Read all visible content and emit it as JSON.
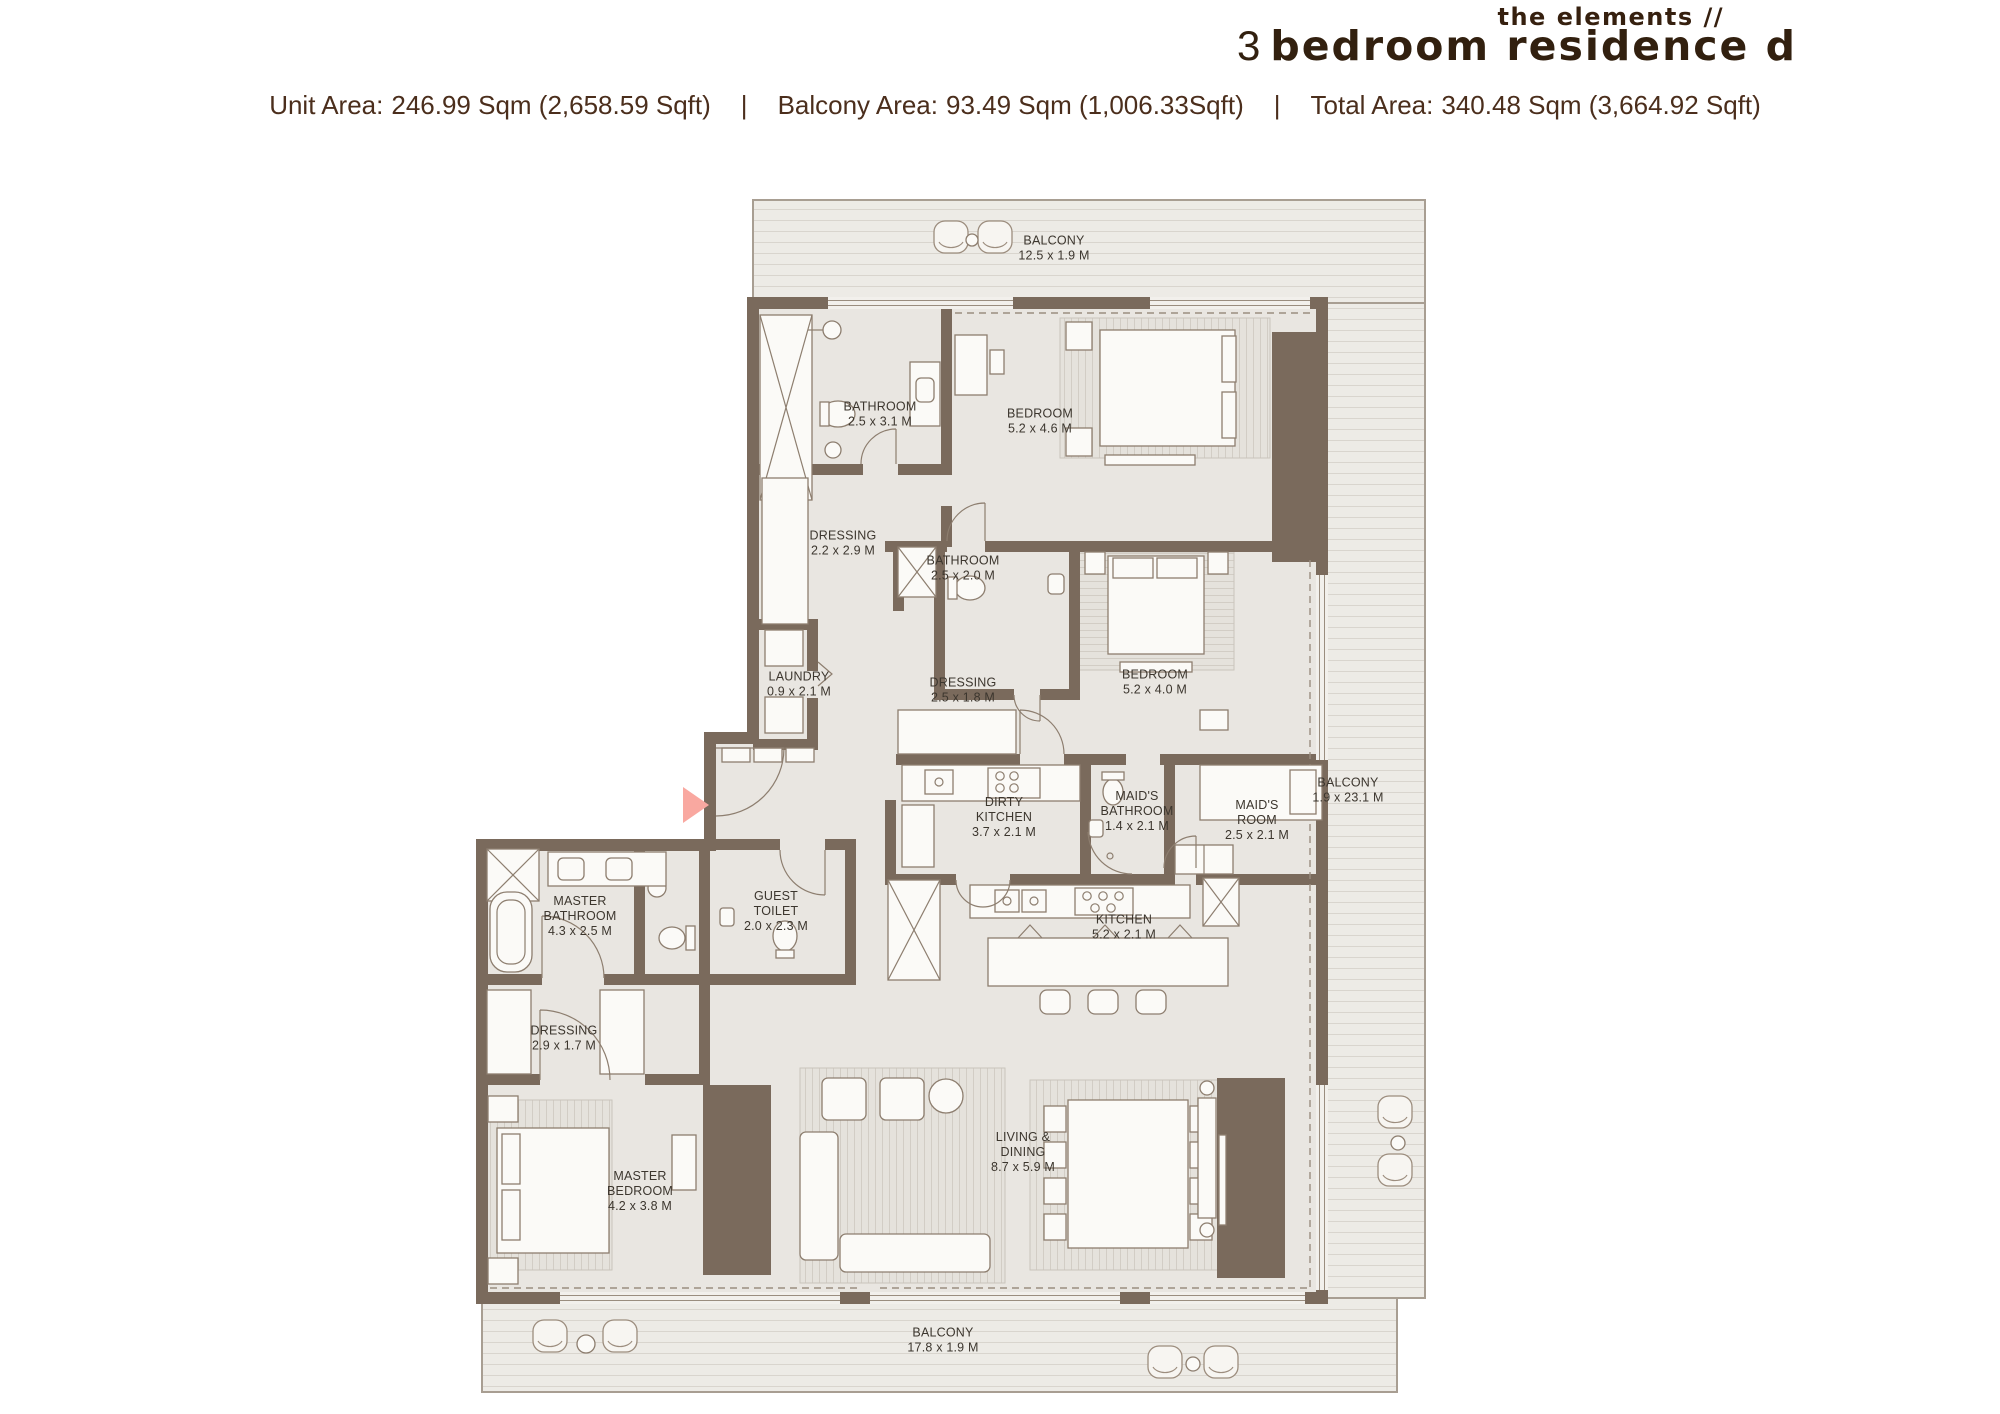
{
  "header": {
    "brand": "the elements //",
    "title_number": "3",
    "title_text": "bedroom residence d",
    "separator": "|",
    "areas": [
      {
        "label": "Unit Area:",
        "value": "246.99 Sqm (2,658.59 Sqft)"
      },
      {
        "label": "Balcony Area:",
        "value": "93.49 Sqm (1,006.33Sqft)"
      },
      {
        "label": "Total Area:",
        "value": "340.48 Sqm (3,664.92 Sqft)"
      }
    ]
  },
  "plan": {
    "colors": {
      "wall": "#7a6a5c",
      "floor": "#e9e6e1",
      "balcony": "#edebe6",
      "entrance_marker": "#f9a8a0"
    },
    "rooms": [
      {
        "id": "balcony-top",
        "name": "BALCONY",
        "dims": "12.5 x 1.9 M",
        "x": 1054,
        "y": 248
      },
      {
        "id": "bathroom-1",
        "name": "BATHROOM",
        "dims": "2.5 x 3.1 M",
        "x": 880,
        "y": 414
      },
      {
        "id": "bedroom-1",
        "name": "BEDROOM",
        "dims": "5.2 x 4.6 M",
        "x": 1040,
        "y": 421
      },
      {
        "id": "dressing-1",
        "name": "DRESSING",
        "dims": "2.2 x 2.9 M",
        "x": 843,
        "y": 543
      },
      {
        "id": "bathroom-2",
        "name": "BATHROOM",
        "dims": "2.5 x 2.0 M",
        "x": 963,
        "y": 568
      },
      {
        "id": "laundry",
        "name": "LAUNDRY",
        "dims": "0.9 x 2.1 M",
        "x": 799,
        "y": 684
      },
      {
        "id": "dressing-2",
        "name": "DRESSING",
        "dims": "2.5 x 1.8 M",
        "x": 963,
        "y": 690
      },
      {
        "id": "bedroom-2",
        "name": "BEDROOM",
        "dims": "5.2 x 4.0 M",
        "x": 1155,
        "y": 682
      },
      {
        "id": "balcony-right",
        "name": "BALCONY",
        "dims": "1.9 x 23.1 M",
        "x": 1348,
        "y": 790
      },
      {
        "id": "dirty-kitchen",
        "name": "DIRTY\nKITCHEN",
        "dims": "3.7 x 2.1 M",
        "x": 1004,
        "y": 817
      },
      {
        "id": "maids-bathroom",
        "name": "MAID'S\nBATHROOM",
        "dims": "1.4 x 2.1 M",
        "x": 1137,
        "y": 811
      },
      {
        "id": "maids-room",
        "name": "MAID'S\nROOM",
        "dims": "2.5 x 2.1 M",
        "x": 1257,
        "y": 820
      },
      {
        "id": "master-bathroom",
        "name": "MASTER\nBATHROOM",
        "dims": "4.3 x 2.5 M",
        "x": 580,
        "y": 916
      },
      {
        "id": "guest-toilet",
        "name": "GUEST\nTOILET",
        "dims": "2.0 x 2.3 M",
        "x": 776,
        "y": 911
      },
      {
        "id": "kitchen",
        "name": "KITCHEN",
        "dims": "5.2 x 2.1 M",
        "x": 1124,
        "y": 927
      },
      {
        "id": "dressing-3",
        "name": "DRESSING",
        "dims": "2.9 x 1.7 M",
        "x": 564,
        "y": 1038
      },
      {
        "id": "master-bedroom",
        "name": "MASTER\nBEDROOM",
        "dims": "4.2 x 3.8 M",
        "x": 640,
        "y": 1191
      },
      {
        "id": "living-dining",
        "name": "LIVING &\nDINING",
        "dims": "8.7 x 5.9 M",
        "x": 1023,
        "y": 1152
      },
      {
        "id": "balcony-bottom",
        "name": "BALCONY",
        "dims": "17.8 x 1.9 M",
        "x": 943,
        "y": 1340
      }
    ]
  }
}
